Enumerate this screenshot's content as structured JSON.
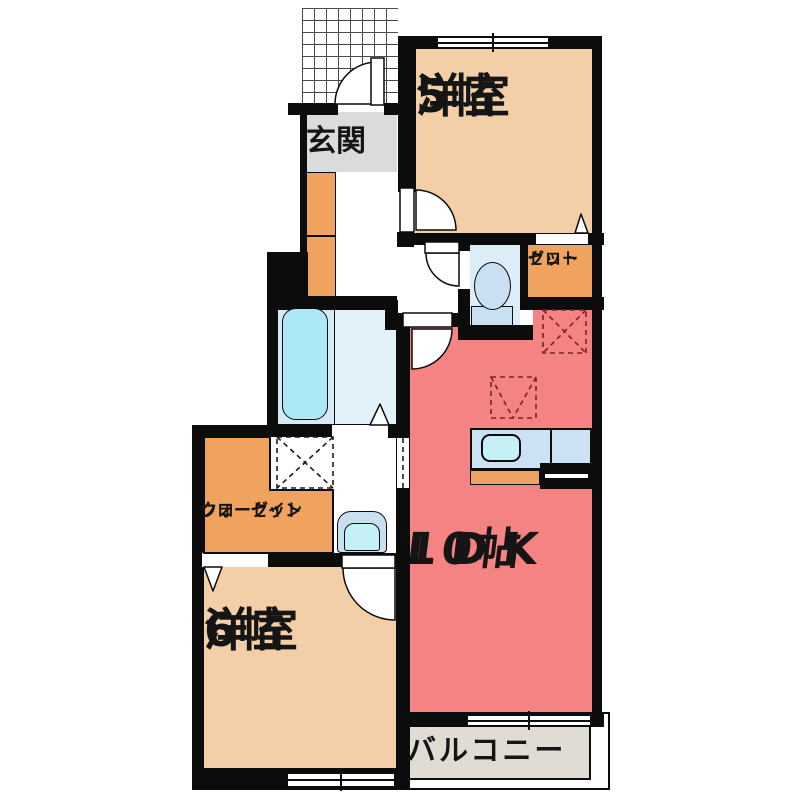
{
  "floorplan": {
    "title": "1LDK apartment floor plan",
    "rooms": {
      "entrance": {
        "label": "玄関"
      },
      "bedroom5": {
        "line1": "洋室",
        "line2": "5帖"
      },
      "closet": {
        "line1": "クロー",
        "line2": "ゼット"
      },
      "ldk": {
        "line1": "LDK",
        "line2": "10帖"
      },
      "walkin_closet": {
        "line1": "ウォークイン",
        "line2": "クローゼット"
      },
      "bedroom6": {
        "line1": "洋室",
        "line2": "6帖"
      },
      "balcony": {
        "label": "バルコニー"
      }
    },
    "colors": {
      "wall": "#0c0c0c",
      "tatami_room": "#F2CFA6",
      "ldk_red": "#F58383",
      "storage_orange": "#EFA35F",
      "entrance_gray": "#DBDBDB",
      "toilet_room": "#DCEDF8",
      "bath_left": "#D5EAF5",
      "bath_right": "#E3F1FA",
      "bathtub": "#ADE9F4",
      "kitchen_counter": "#CCE2F4",
      "kitchen_sink": "#C4F0F6",
      "fixture_blue": "#C9E0F3",
      "balcony_beige": "#E0DCD3"
    }
  }
}
